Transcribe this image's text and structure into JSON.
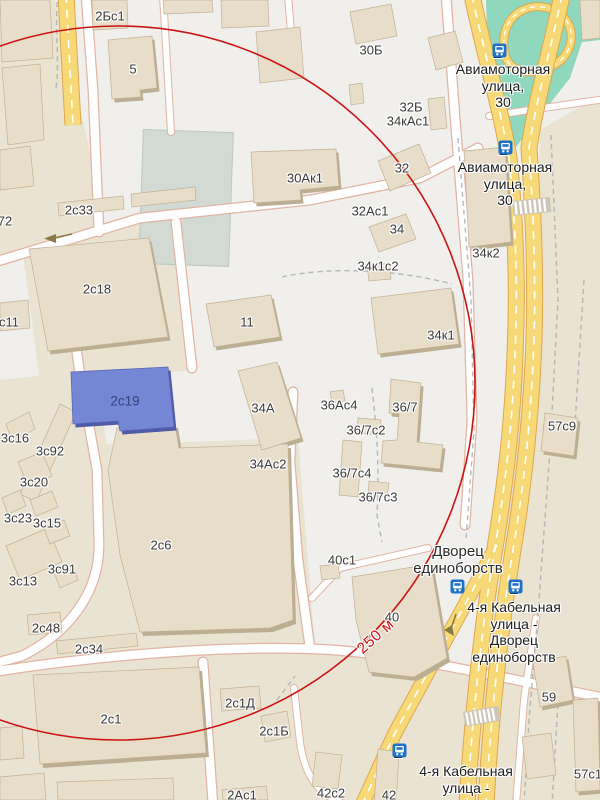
{
  "colors": {
    "highlight": "#7486d4",
    "highlight_text": "#36437f",
    "radius": "#cd1414",
    "primary_road": "#f8d977",
    "green": "#8fd7bd",
    "transit": "#1d72c8"
  },
  "map": {
    "building_labels": [
      {
        "t": "2Бс1",
        "x": 110,
        "y": 16
      },
      {
        "t": "5",
        "x": 133,
        "y": 69
      },
      {
        "t": "30Б",
        "x": 371,
        "y": 50
      },
      {
        "t": "32Б",
        "x": 411,
        "y": 107
      },
      {
        "t": "34кАс1",
        "x": 408,
        "y": 121
      },
      {
        "t": "32",
        "x": 402,
        "y": 168
      },
      {
        "t": "30Ак1",
        "x": 305,
        "y": 178
      },
      {
        "t": "2с33",
        "x": 79,
        "y": 210
      },
      {
        "t": "72",
        "x": 5,
        "y": 221
      },
      {
        "t": "32Ас1",
        "x": 370,
        "y": 211
      },
      {
        "t": "34",
        "x": 397,
        "y": 229
      },
      {
        "t": "34к2",
        "x": 486,
        "y": 253
      },
      {
        "t": "34к1с2",
        "x": 378,
        "y": 266
      },
      {
        "t": "2с18",
        "x": 97,
        "y": 289
      },
      {
        "t": "с11",
        "x": 9,
        "y": 322
      },
      {
        "t": "11",
        "x": 247,
        "y": 322
      },
      {
        "t": "34к1",
        "x": 441,
        "y": 335
      },
      {
        "t": "2с19",
        "x": 125,
        "y": 401,
        "type": "hl"
      },
      {
        "t": "34А",
        "x": 263,
        "y": 408
      },
      {
        "t": "36Ас4",
        "x": 339,
        "y": 405
      },
      {
        "t": "36/7",
        "x": 405,
        "y": 407
      },
      {
        "t": "3с16",
        "x": 15,
        "y": 438
      },
      {
        "t": "36/7с2",
        "x": 366,
        "y": 430
      },
      {
        "t": "3с92",
        "x": 50,
        "y": 451
      },
      {
        "t": "34Ас2",
        "x": 268,
        "y": 464
      },
      {
        "t": "36/7с4",
        "x": 352,
        "y": 473
      },
      {
        "t": "3с20",
        "x": 34,
        "y": 482
      },
      {
        "t": "36/7с3",
        "x": 378,
        "y": 497
      },
      {
        "t": "3с23",
        "x": 18,
        "y": 518
      },
      {
        "t": "3с15",
        "x": 47,
        "y": 523
      },
      {
        "t": "57с9",
        "x": 562,
        "y": 426
      },
      {
        "t": "2с6",
        "x": 161,
        "y": 545
      },
      {
        "t": "40с1",
        "x": 342,
        "y": 560
      },
      {
        "t": "3с91",
        "x": 62,
        "y": 569
      },
      {
        "t": "3с13",
        "x": 23,
        "y": 581
      },
      {
        "t": "40",
        "x": 392,
        "y": 617
      },
      {
        "t": "2с48",
        "x": 46,
        "y": 628
      },
      {
        "t": "250 м",
        "x": 376,
        "y": 637,
        "type": "radius",
        "rot": -42
      },
      {
        "t": "2с34",
        "x": 89,
        "y": 649
      },
      {
        "t": "59",
        "x": 549,
        "y": 697
      },
      {
        "t": "2с1",
        "x": 111,
        "y": 719
      },
      {
        "t": "2с1Д",
        "x": 240,
        "y": 703
      },
      {
        "t": "2с1Б",
        "x": 274,
        "y": 731
      },
      {
        "t": "57с1",
        "x": 588,
        "y": 774
      },
      {
        "t": "42с2",
        "x": 331,
        "y": 793
      },
      {
        "t": "42",
        "x": 389,
        "y": 795
      },
      {
        "t": "2Ас1",
        "x": 242,
        "y": 795
      }
    ],
    "multiline_labels": [
      {
        "x": 503,
        "y": 61,
        "lines": [
          "Авиамоторная",
          "улица,",
          "30"
        ],
        "type": "stop"
      },
      {
        "x": 505,
        "y": 159,
        "lines": [
          "Авиамоторная",
          "улица,",
          "30"
        ],
        "type": "stop"
      },
      {
        "x": 458,
        "y": 543,
        "lines": [
          "Дворец",
          "единоборств"
        ],
        "type": "place"
      },
      {
        "x": 514,
        "y": 599,
        "lines": [
          "4-я Кабельная",
          "улица -",
          "Дворец",
          "единоборств"
        ],
        "type": "stop"
      },
      {
        "x": 466,
        "y": 763,
        "lines": [
          "4-я Кабельная",
          "улица -"
        ],
        "type": "stop"
      }
    ],
    "transit_stops": [
      {
        "n": "2",
        "x": 492,
        "y": 43
      },
      {
        "n": "2",
        "x": 498,
        "y": 140
      },
      {
        "n": "",
        "x": 450,
        "y": 579
      },
      {
        "n": "1",
        "x": 508,
        "y": 579
      },
      {
        "n": "1",
        "x": 392,
        "y": 743
      }
    ]
  }
}
